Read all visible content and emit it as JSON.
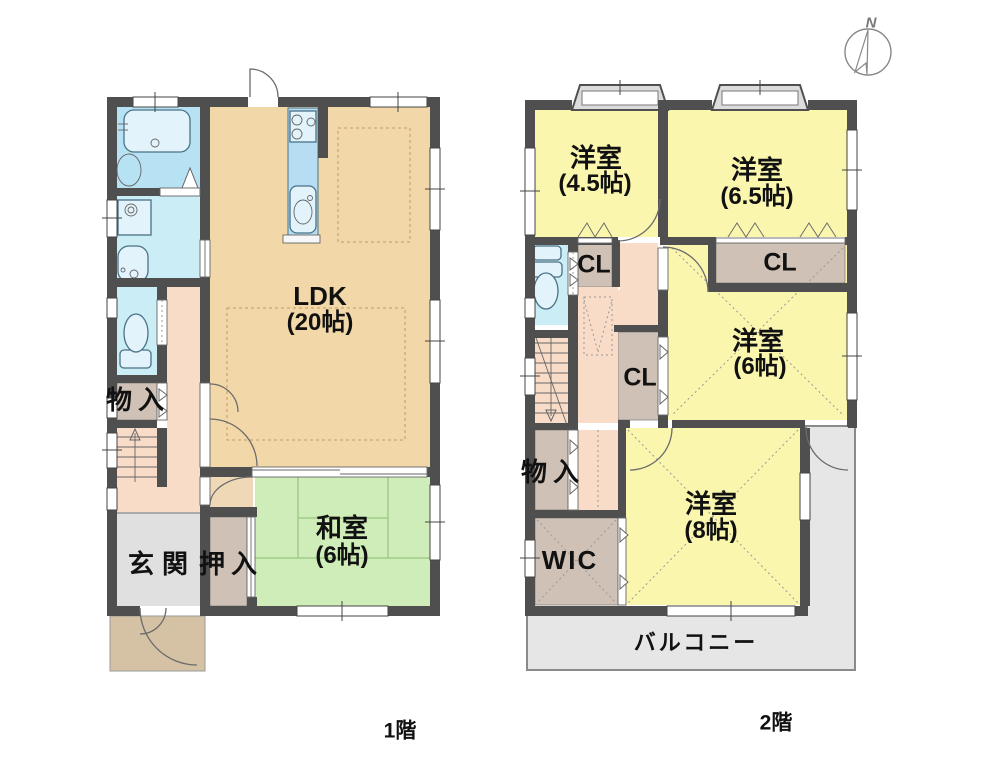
{
  "floor1": {
    "caption": "1階",
    "rooms": {
      "ldk": {
        "name": "LDK",
        "area": "(20帖)"
      },
      "washitsu": {
        "name": "和室",
        "area": "(6帖)"
      },
      "genkan": {
        "name": "玄関"
      },
      "oshiire": {
        "name": "押入"
      },
      "mononyu": {
        "name": "物入"
      }
    }
  },
  "floor2": {
    "caption": "2階",
    "rooms": {
      "yoshitsu_45": {
        "name": "洋室",
        "area": "(4.5帖)"
      },
      "yoshitsu_65": {
        "name": "洋室",
        "area": "(6.5帖)"
      },
      "yoshitsu_6": {
        "name": "洋室",
        "area": "(6帖)"
      },
      "yoshitsu_8": {
        "name": "洋室",
        "area": "(8帖)"
      },
      "closets": [
        "CL",
        "CL",
        "CL"
      ],
      "mononyu": {
        "name": "物入"
      },
      "wic": {
        "name": "WIC"
      },
      "balcony": {
        "name": "バルコニー"
      }
    }
  },
  "compass": {
    "north": "N"
  },
  "colors": {
    "wall": "#4F4F4F",
    "ldk_floor": "#F2D8A8",
    "hallway_floor": "#F8DCC8",
    "tatami_floor": "#CFEDB8",
    "western_room_floor": "#FAF6AE",
    "bathroom_floor": "#B7E2F3",
    "sanitary_floor": "#CBEDF6",
    "closet_floor": "#CFC1B5",
    "entrance_floor": "#E0E0E0",
    "porch": "#D5C2A4",
    "balcony_floor": "#E6E6E6"
  }
}
